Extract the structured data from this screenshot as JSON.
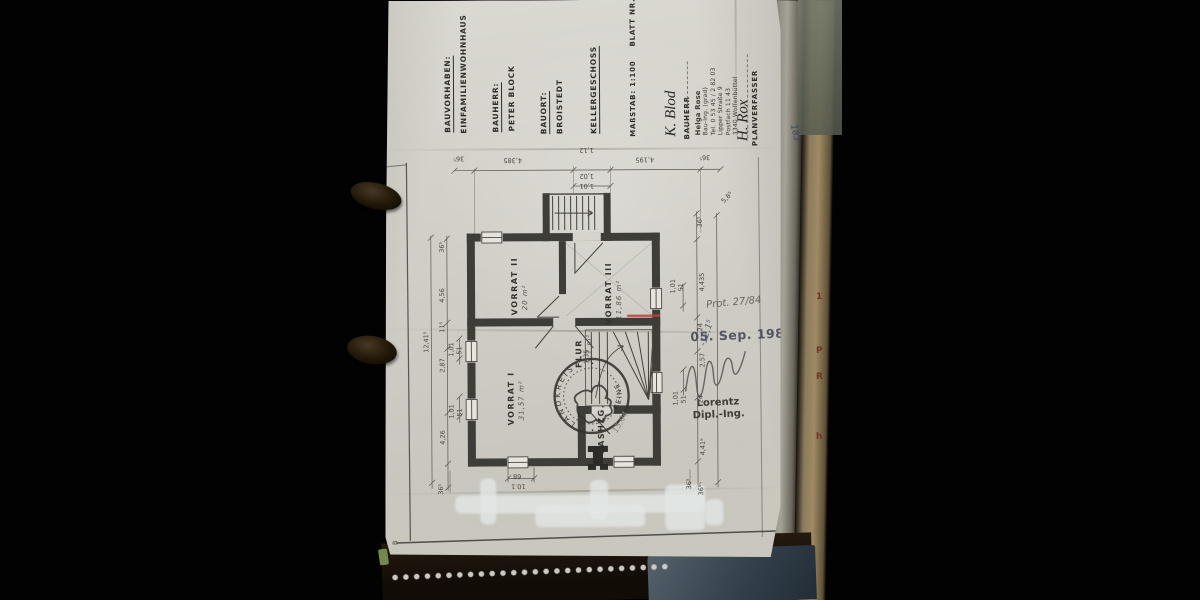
{
  "scene": {
    "description": "Photograph of a 1984 German basement floor plan sheet clipped in a ring binder"
  },
  "titleblock": {
    "bauvorhaben_label": "BAUVORHABEN:",
    "bauvorhaben_value": "EINFAMILIENWOHNHAUS",
    "bauherr_label": "BAUHERR:",
    "bauherr_value": "PETER BLOCK",
    "bauort_label": "BAUORT:",
    "bauort_value": "BROISTEDT",
    "sheet_title": "KELLERGESCHOSS",
    "scale_label": "MAßSTAB: 1:100",
    "sheet_no": "BLATT NR. 3"
  },
  "signatures": {
    "owner_signature": "K. Blod",
    "owner_caption": "BAUHERR",
    "planner_signature": "H. Rox",
    "planner_caption": "PLANVERFASSER"
  },
  "address_stamp": {
    "name": "Helga Rose",
    "title": "Bau-Ing. (grad)",
    "phone": "Tel. 0 53 45 / 2 82 03",
    "street": "Lipper Straße 9",
    "postbox": "Postfach 11 43",
    "city": "3340 Wolfenbüttel"
  },
  "approval": {
    "date_stamp": "05. Sep. 1984",
    "file_note": "Prot. 27/84",
    "level_note": "-12,1⁵",
    "approver_name": "Lorentz",
    "approver_title": "Dipl.-Ing."
  },
  "round_stamp": {
    "top_text": "LANDKREIS",
    "bottom_text": "PEINE",
    "center": "GAS"
  },
  "rooms": [
    {
      "name": "VORRAT II",
      "area": "20 m²",
      "x": 126,
      "y": 315
    },
    {
      "name": "VORRAT III",
      "area": "11,86 m²",
      "x": 220,
      "y": 325
    },
    {
      "name": "VORRAT I",
      "area": "31,57 m²",
      "x": 122,
      "y": 425
    },
    {
      "name": "FLUR",
      "area": "7,1 m²",
      "x": 190,
      "y": 368
    },
    {
      "name": "GASHZG.",
      "area": "",
      "x": 212,
      "y": 455
    }
  ],
  "plan_annotations": [
    {
      "t": "36⁵",
      "x": 70,
      "y": 154,
      "r": 180
    },
    {
      "t": "4,385",
      "x": 120,
      "y": 156,
      "r": 180
    },
    {
      "t": "1,12",
      "x": 196,
      "y": 146,
      "r": 180
    },
    {
      "t": "1,02",
      "x": 196,
      "y": 172,
      "r": 180
    },
    {
      "t": "1,01",
      "x": 196,
      "y": 182,
      "r": 180
    },
    {
      "t": "4,195",
      "x": 252,
      "y": 156,
      "r": 180
    },
    {
      "t": "36⁵",
      "x": 316,
      "y": 154,
      "r": 180
    },
    {
      "t": "5,8⁵",
      "x": 336,
      "y": 200,
      "r": -45
    },
    {
      "t": "12,41⁵",
      "x": 38,
      "y": 352,
      "r": -90
    },
    {
      "t": "36⁵",
      "x": 54,
      "y": 252,
      "r": -90
    },
    {
      "t": "4,56",
      "x": 54,
      "y": 302,
      "r": -90
    },
    {
      "t": "11⁵",
      "x": 54,
      "y": 332,
      "r": -90
    },
    {
      "t": "2,87",
      "x": 54,
      "y": 372,
      "r": -90
    },
    {
      "t": "4,26",
      "x": 54,
      "y": 444,
      "r": -90
    },
    {
      "t": "36⁵",
      "x": 52,
      "y": 494,
      "r": -90
    },
    {
      "t": "1,01",
      "x": 63,
      "y": 356,
      "r": -90
    },
    {
      "t": "51",
      "x": 71,
      "y": 354,
      "r": -90
    },
    {
      "t": "1,01",
      "x": 63,
      "y": 418,
      "r": -90
    },
    {
      "t": "51",
      "x": 71,
      "y": 416,
      "r": -90
    },
    {
      "t": "36⁵",
      "x": 312,
      "y": 228,
      "r": -90
    },
    {
      "t": "4,435",
      "x": 314,
      "y": 292,
      "r": -90
    },
    {
      "t": "24",
      "x": 312,
      "y": 332,
      "r": -90
    },
    {
      "t": "2,57",
      "x": 314,
      "y": 368,
      "r": -90
    },
    {
      "t": "24",
      "x": 312,
      "y": 404,
      "r": -90
    },
    {
      "t": "4,41⁵",
      "x": 314,
      "y": 456,
      "r": -90
    },
    {
      "t": "36⁵",
      "x": 312,
      "y": 496,
      "r": -90
    },
    {
      "t": "1,01",
      "x": 285,
      "y": 294,
      "r": -90
    },
    {
      "t": "51",
      "x": 293,
      "y": 292,
      "r": -90
    },
    {
      "t": "1,01",
      "x": 287,
      "y": 406,
      "r": -90
    },
    {
      "t": "51",
      "x": 295,
      "y": 404,
      "r": -90
    },
    {
      "t": "68",
      "x": 128,
      "y": 472,
      "r": 180
    },
    {
      "t": "10.1",
      "x": 126,
      "y": 482,
      "r": 180
    },
    {
      "t": "36⁵",
      "x": 300,
      "y": 490,
      "r": -90
    },
    {
      "t": "1,35",
      "x": 198,
      "y": 364,
      "r": -90
    },
    {
      "t": "15,04",
      "x": 226,
      "y": 430,
      "r": -60,
      "hw": true
    },
    {
      "t": "B",
      "x": 6,
      "y": 544,
      "r": -90
    }
  ],
  "binder": {
    "edge_number": "183",
    "edge_letters": [
      "1",
      "P",
      "R",
      "h"
    ]
  }
}
